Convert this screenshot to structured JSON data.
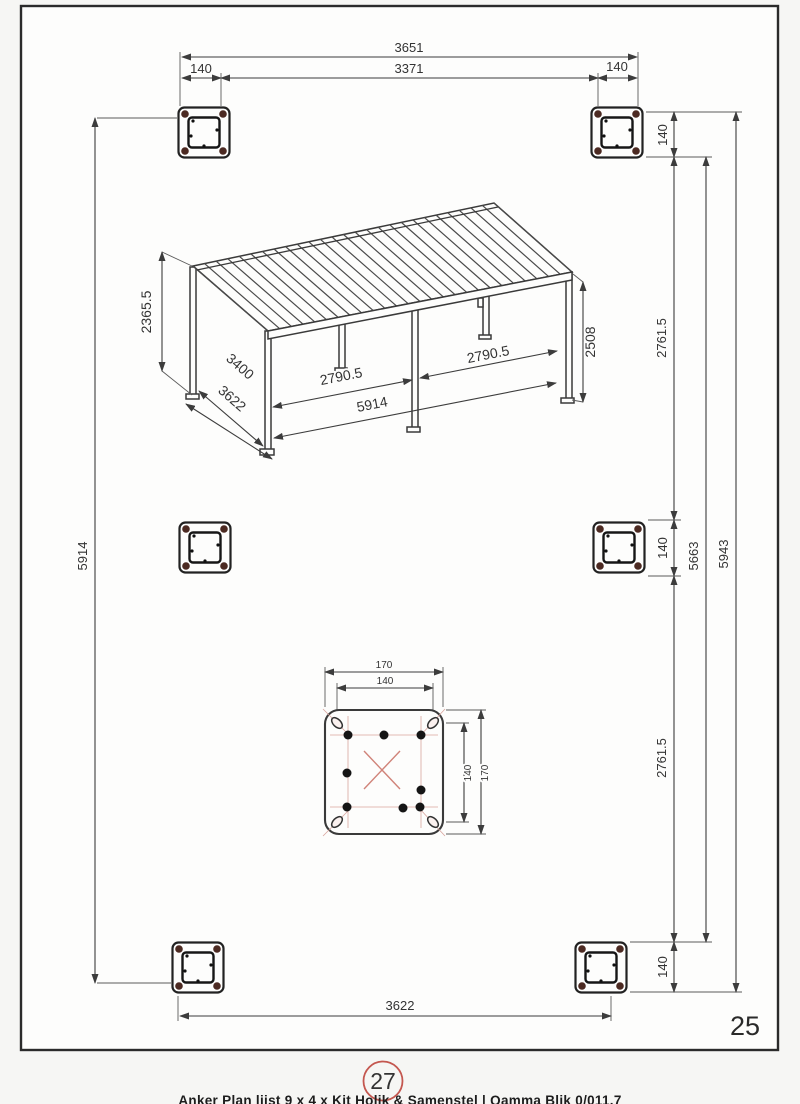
{
  "page": {
    "number": "25",
    "detail_ref": "27",
    "caption_partial": "Anker Plan lijst 9 x 4 x Kit Holik & Samenstel | Qamma Blik 0/011.7"
  },
  "dims": {
    "top": {
      "overall": "3651",
      "left_offset": "140",
      "inner": "3371",
      "right_offset": "140"
    },
    "left": {
      "total": "5914"
    },
    "right": {
      "top_post": "140",
      "upper_span": "2761.5",
      "mid_post": "140",
      "lower_span": "2761.5",
      "bottom_post": "140",
      "inner_total": "5663",
      "outer_total": "5943"
    },
    "bottom": {
      "span": "3622"
    },
    "pergola": {
      "height_rear": "2365.5",
      "depth_inner": "3400",
      "depth_outer": "3622",
      "bay_left": "2790.5",
      "bay_right": "2790.5",
      "front_span": "5914",
      "height_front": "2508"
    },
    "plate": {
      "width_outer": "170",
      "width_inner": "140",
      "height_outer": "170",
      "height_inner": "140"
    }
  },
  "colors": {
    "line": "#3a3a3a",
    "anchor_dot": "#4c2a22",
    "red_accent": "#d08379",
    "ref_circle": "#c4574f"
  },
  "drawing": {
    "roof_slat_count": 27,
    "roof_corners": [
      [
        193,
        266
      ],
      [
        494,
        203
      ],
      [
        572,
        272
      ],
      [
        268,
        331
      ]
    ]
  }
}
